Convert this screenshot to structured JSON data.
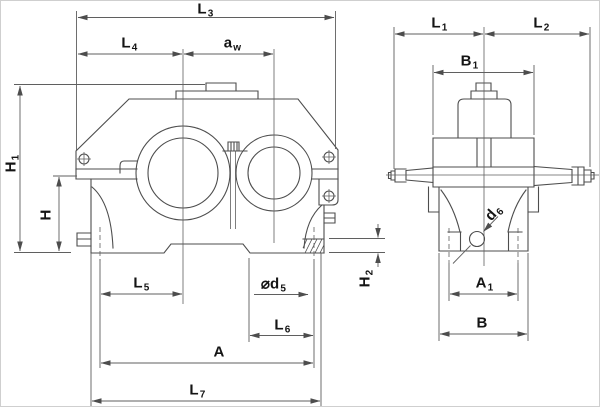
{
  "drawing_type": "gear-reducer-dimension-drawing",
  "colors": {
    "line": "#4d4d4d",
    "thin": "#5f5f5f",
    "label": "#141414",
    "background": "#ffffff"
  },
  "labels": {
    "l3": {
      "base": "L",
      "sub": "3"
    },
    "l4": {
      "base": "L",
      "sub": "4"
    },
    "aw": {
      "base": "a",
      "sub": "w"
    },
    "h1": {
      "base": "H",
      "sub": "1"
    },
    "h": {
      "base": "H",
      "sub": ""
    },
    "h2": {
      "base": "H",
      "sub": "2"
    },
    "l5": {
      "base": "L",
      "sub": "5"
    },
    "d5": {
      "base": "⌀d",
      "sub": "5"
    },
    "l6": {
      "base": "L",
      "sub": "6"
    },
    "a": {
      "base": "A",
      "sub": ""
    },
    "l7": {
      "base": "L",
      "sub": "7"
    },
    "l1": {
      "base": "L",
      "sub": "1"
    },
    "l2": {
      "base": "L",
      "sub": "2"
    },
    "b1": {
      "base": "B",
      "sub": "1"
    },
    "a1": {
      "base": "A",
      "sub": "1"
    },
    "b": {
      "base": "B",
      "sub": ""
    },
    "d6": {
      "base": "d",
      "sub": "6"
    }
  }
}
